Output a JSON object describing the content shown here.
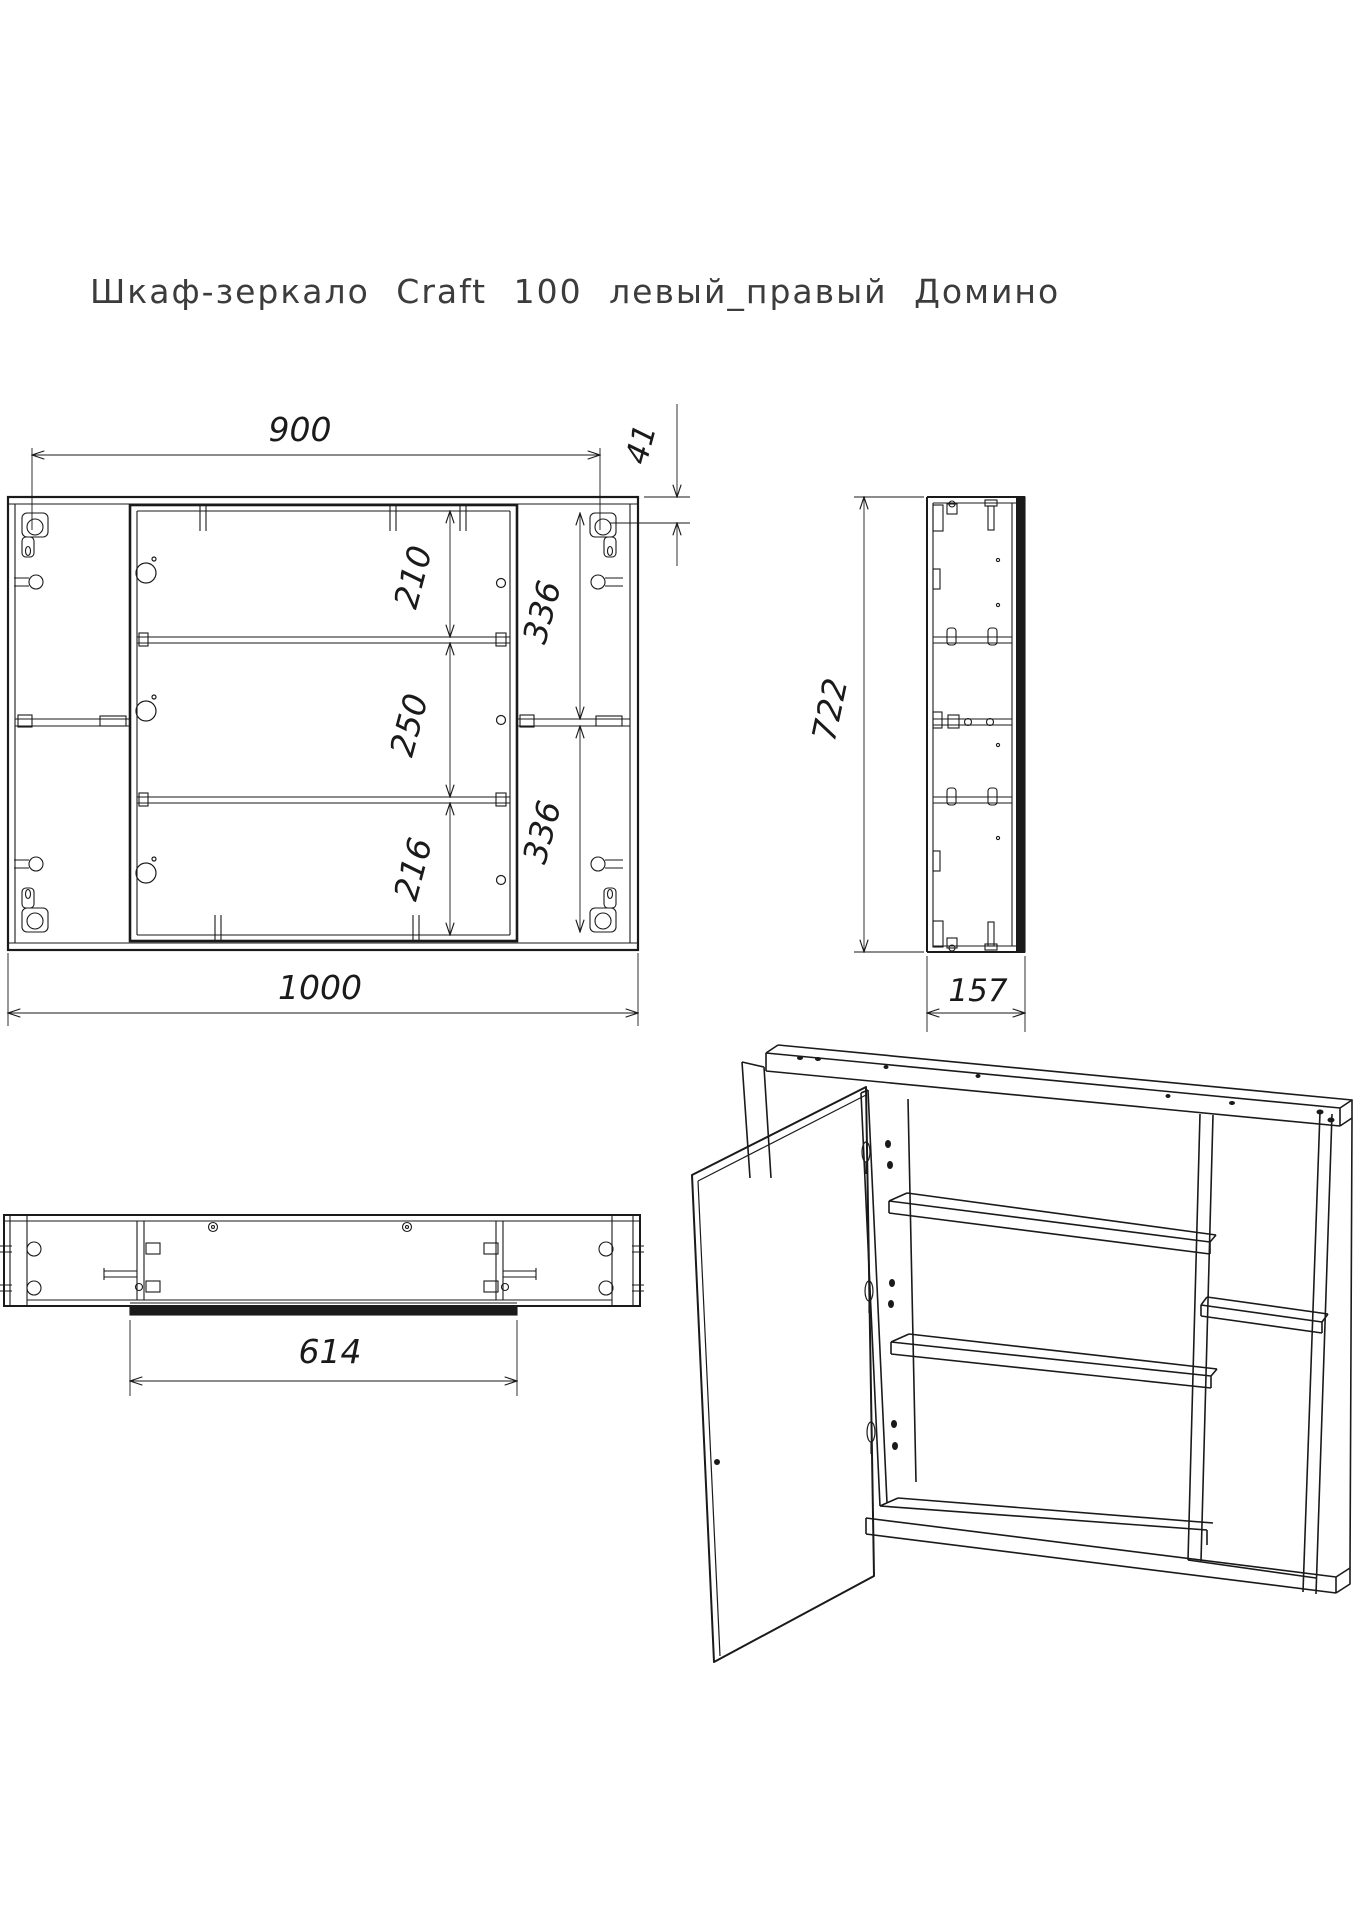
{
  "sheet": {
    "background": "#ffffff",
    "line_color": "#1a1a1a",
    "title_color": "#3c3c3c"
  },
  "title": "Шкаф-зеркало Craft 100 левый_правый Домино",
  "front_view": {
    "dim_mount_width": "900",
    "dim_mount_offset": "41",
    "dim_shelf_top": "210",
    "dim_shelf_middle": "250",
    "dim_shelf_bottom": "216",
    "dim_right_upper": "336",
    "dim_right_lower": "336",
    "dim_total_width": "1000"
  },
  "side_view": {
    "dim_height": "722",
    "dim_depth": "157"
  },
  "bottom_view": {
    "dim_door_width": "614"
  }
}
